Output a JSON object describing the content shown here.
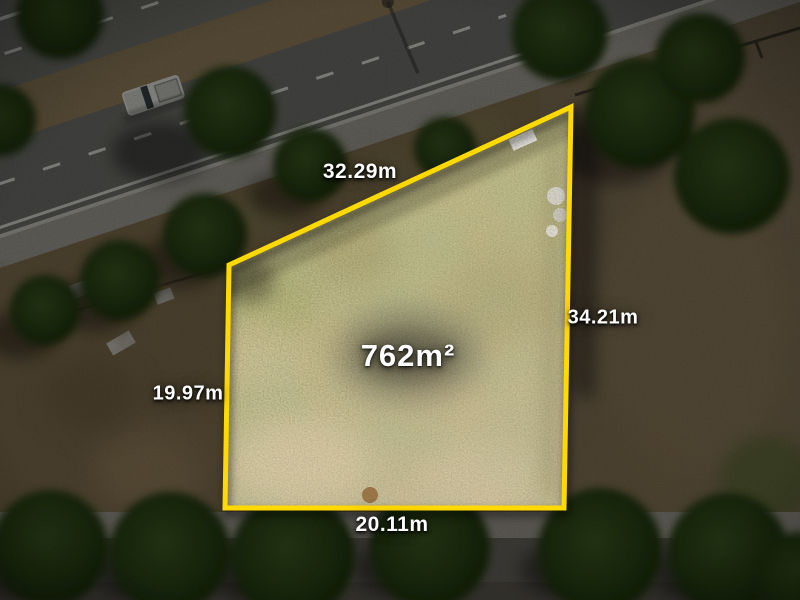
{
  "photo": {
    "area_label": "762m²",
    "dimensions": {
      "top": "32.29m",
      "right": "34.21m",
      "left": "19.97m",
      "bottom": "20.11m"
    },
    "colors": {
      "boundary": "#FFD900",
      "label_text": "#FFFFFF"
    }
  }
}
